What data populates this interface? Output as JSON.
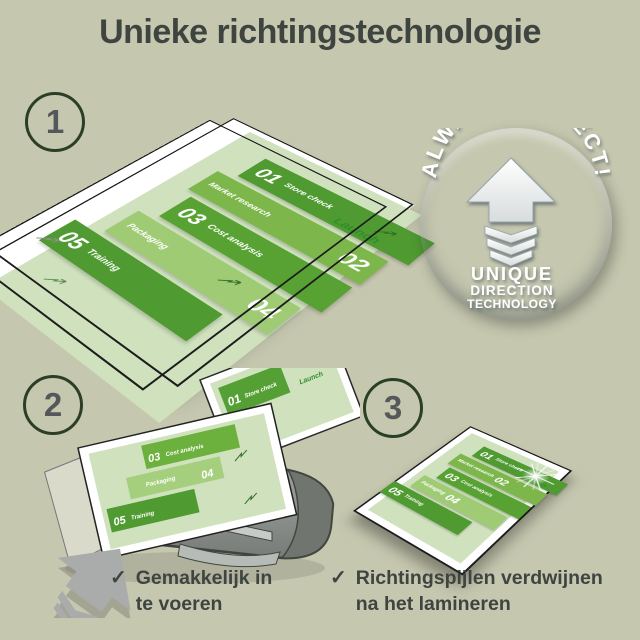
{
  "title": "Unieke richtingstechnologie",
  "steps": {
    "one": "1",
    "two": "2",
    "three": "3"
  },
  "badge": {
    "arc": "ALWAYS PERFECT!",
    "line1": "UNIQUE",
    "line2": "DIRECTION",
    "line3": "TECHNOLOGY"
  },
  "doc": {
    "items": [
      {
        "num": "01",
        "label": "Store check"
      },
      {
        "num": "02",
        "label": "Market research"
      },
      {
        "num": "03",
        "label": "Cost analysis"
      },
      {
        "num": "04",
        "label": "Packaging"
      },
      {
        "num": "05",
        "label": "Training"
      }
    ],
    "launch": "Launch"
  },
  "checklist": {
    "item1": {
      "mark": "✓",
      "line1": "Gemakkelijk in",
      "line2": "te voeren"
    },
    "item2": {
      "mark": "✓",
      "line1": "Richtingspijlen verdwijnen",
      "line2": "na het lamineren"
    }
  },
  "colors": {
    "background": "#c6c7af",
    "text": "#3e4440",
    "green_dark": "#4f9a31",
    "green_mid": "#7db74c",
    "green_light": "#9fcb74",
    "panel_green": "#cfe2bd",
    "launch_green": "#2f8f28",
    "badge_blue": "#7b91a0",
    "machine_gray": "#8e938f",
    "arrow_gray": "#a9acab"
  }
}
